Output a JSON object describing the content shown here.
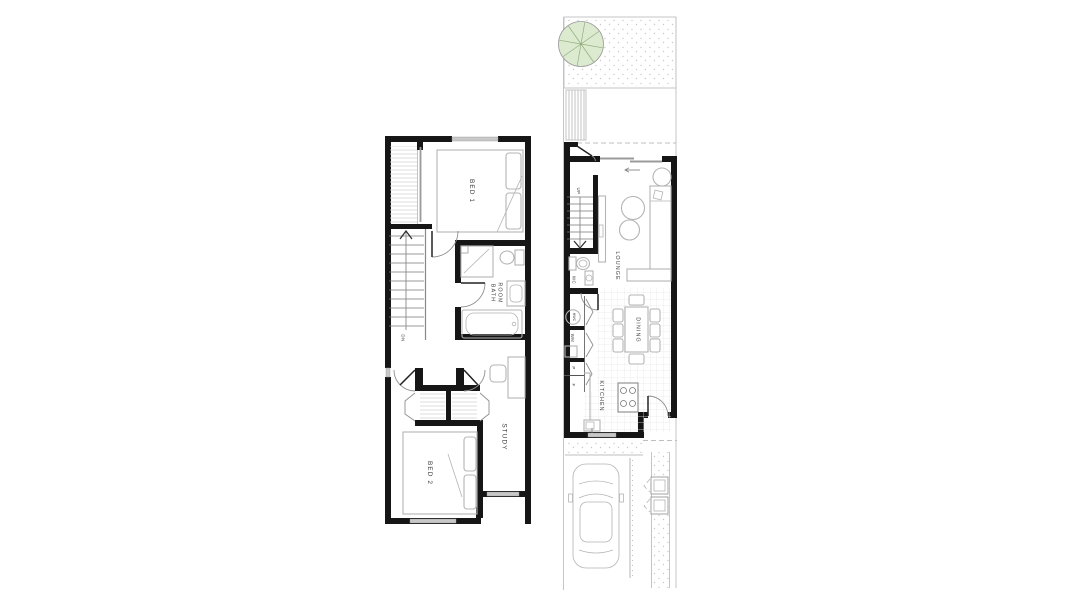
{
  "document": {
    "type": "architectural-floor-plan",
    "sheet_background": "#ffffff"
  },
  "first_floor": {
    "labels": {
      "bed1": "BED 1",
      "bath_line1": "BATH",
      "bath_line2": "ROOM",
      "stairs_down": "DN",
      "bed2": "BED 2",
      "study": "STUDY"
    }
  },
  "ground_floor": {
    "labels": {
      "stairs_up": "UP",
      "lounge": "LOUNGE",
      "wc": "WC",
      "hot_water_cylinder": "HWC",
      "washing_machine": "WM",
      "pantry": "P",
      "fridge": "F",
      "dining": "DINING",
      "kitchen": "KITCHEN"
    }
  },
  "colors": {
    "wall": "#161616",
    "window": "#c8c8c8",
    "fixture": "#b4b4b4",
    "door": "#8f8f8f",
    "hatch": "#d3d3d3",
    "grid": "#e7e7e7",
    "stipple": "#c9c9c9",
    "site_line": "#bfbfbf",
    "tree_fill": "#dcead0",
    "tree_stroke": "#93ad7f",
    "label_text": "#3c3c3c"
  }
}
